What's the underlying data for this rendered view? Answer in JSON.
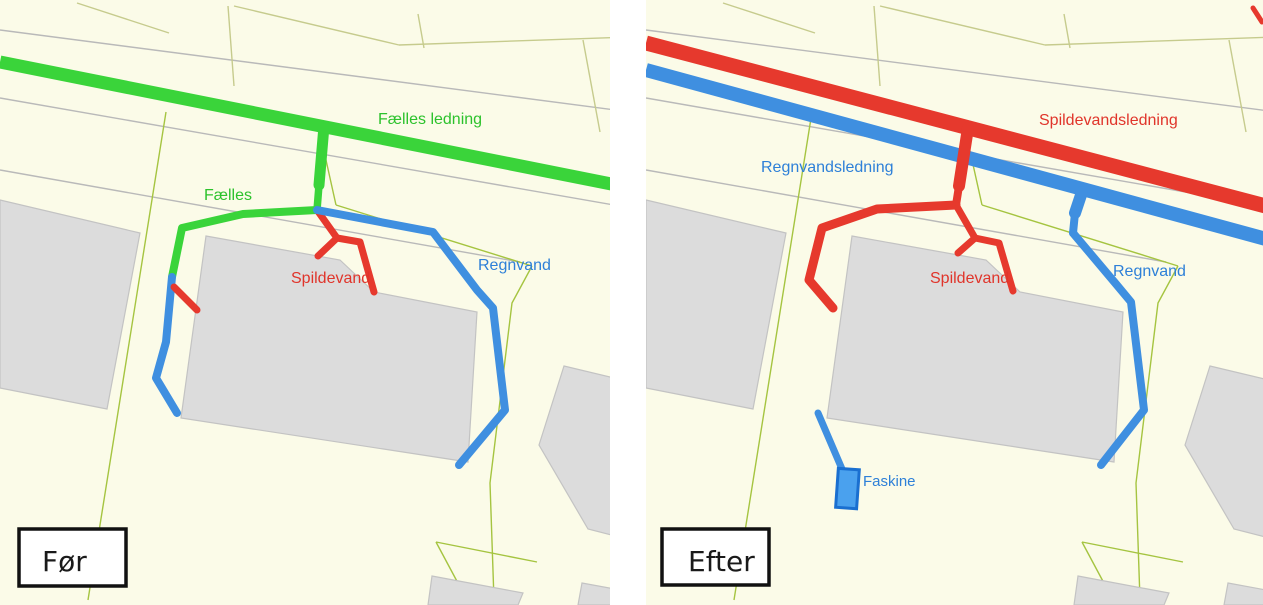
{
  "colors": {
    "bg": "#fbfbe8",
    "panel_gap": "#ffffff",
    "road": "#b9b9b9",
    "parcel_dull": "#c6cb8d",
    "parcel_bright": "#a5c440",
    "building": "#dcdcdc",
    "building_stroke": "#c3c3c3",
    "green": "#3ad43a",
    "red": "#e6392d",
    "blue": "#3f8fe0",
    "green_label": "#2cc22c",
    "red_label": "#e0342a",
    "blue_label": "#2e80d8",
    "faskine_fill": "#4aa1ee",
    "faskine_stroke": "#1a6fd0",
    "box_border": "#111111",
    "box_text": "#1a1a1a"
  },
  "before_panel": {
    "badge": "Før",
    "labels": {
      "common_main": "Fælles ledning",
      "common_branch": "Fælles",
      "sewage": "Spildevand",
      "rain": "Regnvand"
    }
  },
  "after_panel": {
    "badge": "Efter",
    "labels": {
      "sewage_main": "Spildevandsledning",
      "rain_main": "Regnvandsledning",
      "sewage": "Spildevand",
      "rain": "Regnvand",
      "soakaway": "Faskine"
    }
  }
}
